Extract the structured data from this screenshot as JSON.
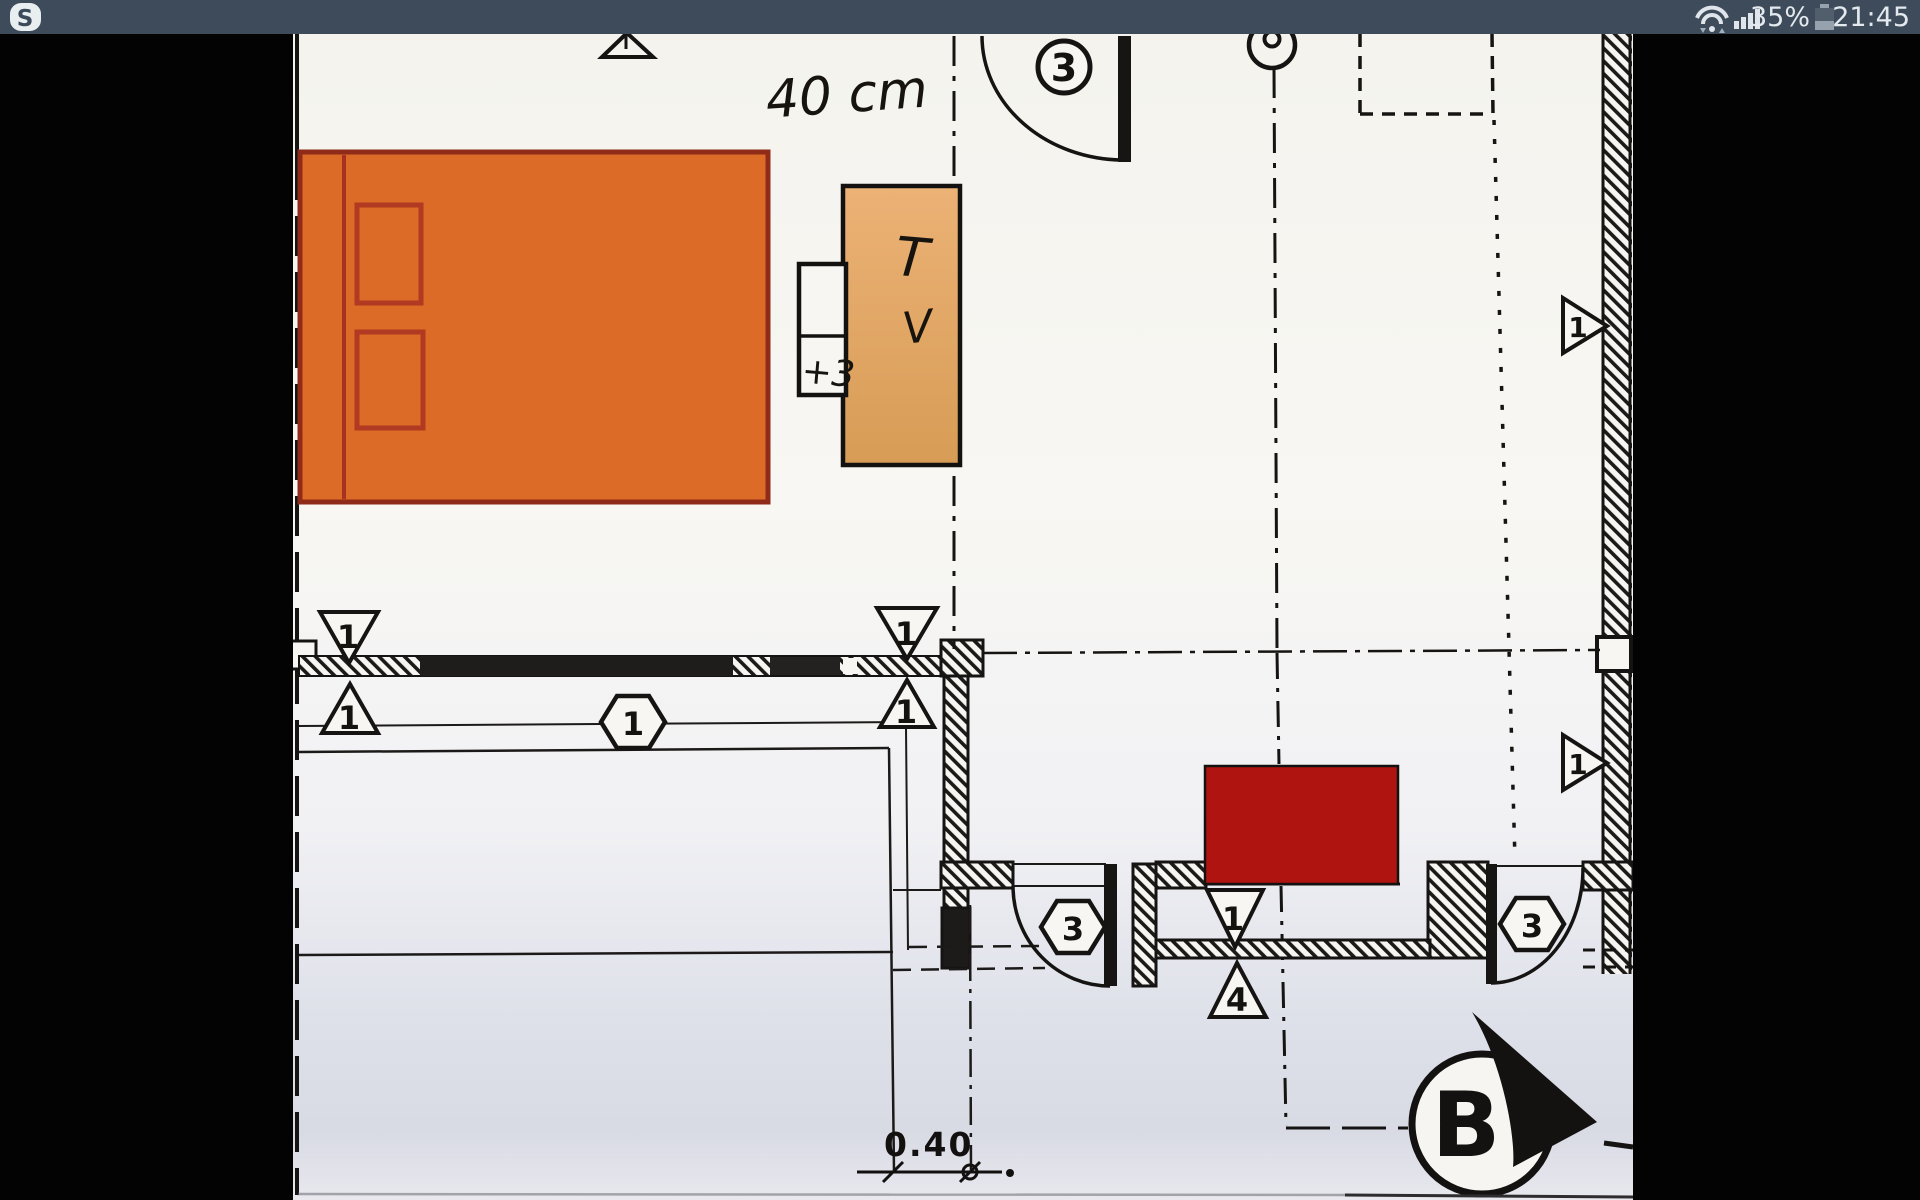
{
  "status_bar": {
    "app_icon_letter": "S",
    "battery_percent": "35%",
    "time": "21:45",
    "bg_color": "#3d4b5a"
  },
  "plan": {
    "handwritten_width_note": "40 cm",
    "tv_label_t": "T",
    "tv_label_v": "V",
    "socket_note": "+3",
    "dim_label": "0.40",
    "section_label": "B",
    "markers": {
      "door_badge": "3",
      "left_top": "1",
      "left_bottom": "1",
      "mid_hex": "1",
      "mid_top": "1",
      "mid_bottom": "1",
      "right_upper": "1",
      "right_lower": "1",
      "low_left_hex": "3",
      "low_right_hex": "3",
      "red_top": "1",
      "red_bottom": "4"
    },
    "colors": {
      "bed_fill": "#dc6b27",
      "bed_border": "#8f2b18",
      "tv_fill": "#e2a763",
      "red_block": "#b01410",
      "paper": "#f7f6f3",
      "line": "#1a1a1a"
    }
  }
}
